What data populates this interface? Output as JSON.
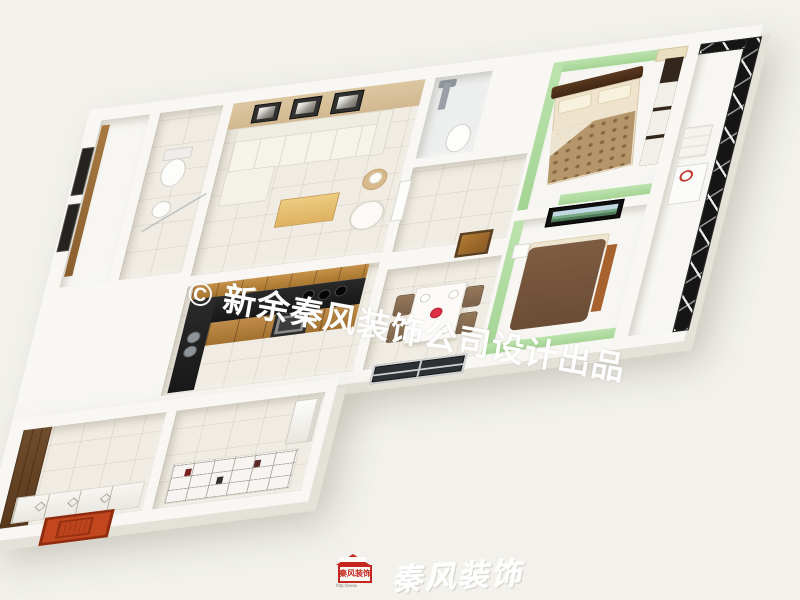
{
  "scene": {
    "description": "3D axonometric dollhouse render of an apartment floor plan",
    "background_color": "#f2f1ec"
  },
  "watermark": {
    "text": "© 新余秦风装饰公司设计出品",
    "color": "#ffffff"
  },
  "brand": {
    "logo_text": "秦风装饰",
    "logo_url": "http://www.",
    "logo_color": "#c3271d",
    "calligraphy_text": "秦风装饰",
    "calligraphy_color": "#ffffff"
  },
  "palette": {
    "wall_white": "#f8f7f3",
    "wall_shadow": "#e4e1d9",
    "floor_tile": "#f0ece3",
    "living_accent_wall": "#d8c19b",
    "bedroom_green_wall": "#b4dfa5",
    "kitchen_wood": "#c08c4a",
    "kitchen_counter": "#212121",
    "entry_door_red": "#c2471f",
    "window_frame_black": "#151515",
    "bed2_brown": "#7a5940",
    "bedspread_pattern": "#b5966b",
    "dining_chair": "#8a7055"
  },
  "rooms": [
    {
      "id": "balcony-left"
    },
    {
      "id": "bathroom-1"
    },
    {
      "id": "living-room"
    },
    {
      "id": "bathroom-2"
    },
    {
      "id": "hallway"
    },
    {
      "id": "master-bedroom"
    },
    {
      "id": "bedroom-2"
    },
    {
      "id": "balcony-right"
    },
    {
      "id": "kitchen"
    },
    {
      "id": "dining-area"
    },
    {
      "id": "storage-room"
    },
    {
      "id": "study-storage"
    }
  ],
  "furniture_icons": [
    "sofa-icon",
    "coffee-table-icon",
    "floor-lamp-icon",
    "tub-chair-icon",
    "picture-frame-icon",
    "toilet-icon",
    "sink-icon",
    "shower-icon",
    "double-bed-icon",
    "wardrobe-icon",
    "tv-landscape-icon",
    "dining-table-icon",
    "chair-icon",
    "flower-icon",
    "window-icon",
    "washing-machine-icon",
    "kitchen-counter-icon",
    "oven-icon",
    "fridge-icon",
    "shelving-icon",
    "cabinet-row-icon",
    "entry-door-icon"
  ]
}
